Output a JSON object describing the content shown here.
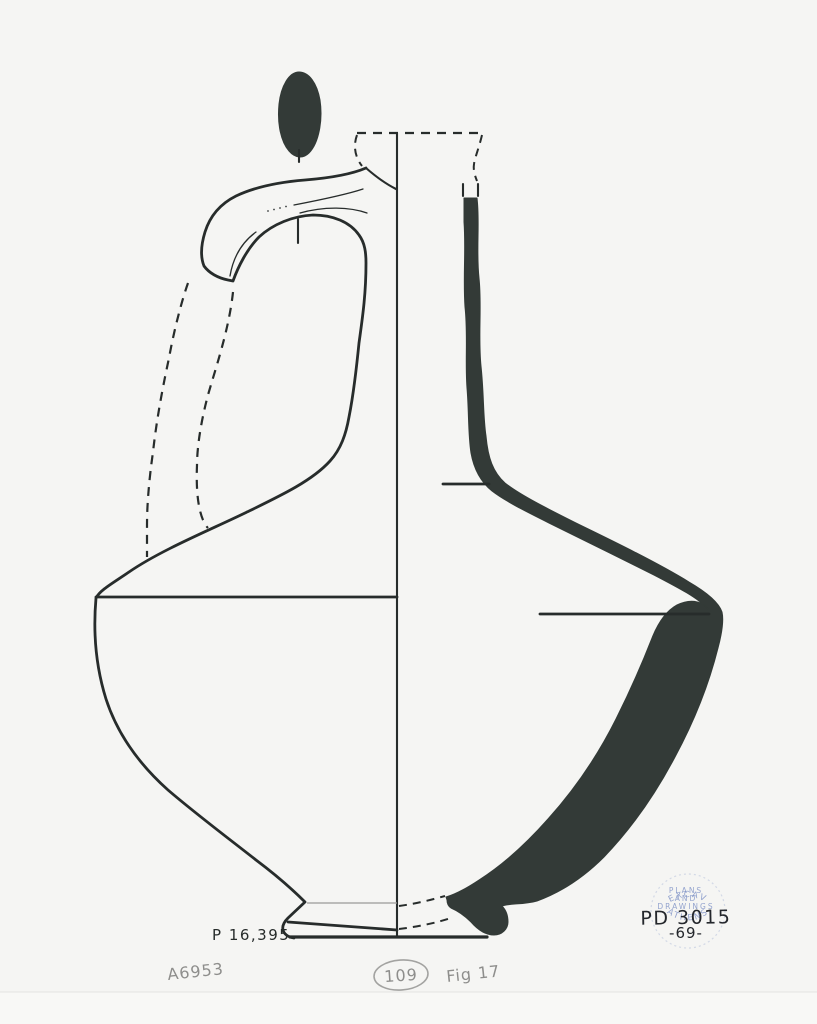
{
  "colors": {
    "paper": "#f5f5f3",
    "ink": "#272c2b",
    "fill": "#333a37",
    "pencil": "#8e8e8c",
    "stamp": "#7b8fc5",
    "hand": "#24272c"
  },
  "labels": {
    "inventory_number": "P 16,395",
    "notebook_number": "A6953",
    "circled_number": "109",
    "figure_note": "Fig 17"
  },
  "stamp": {
    "arc_top": "EXCAV",
    "line_1": "PLANS",
    "line_2": "AND",
    "line_3": "DRAWINGS",
    "arc_bottom": "ATHENS",
    "number": "PD 3015",
    "year": "-69-"
  }
}
